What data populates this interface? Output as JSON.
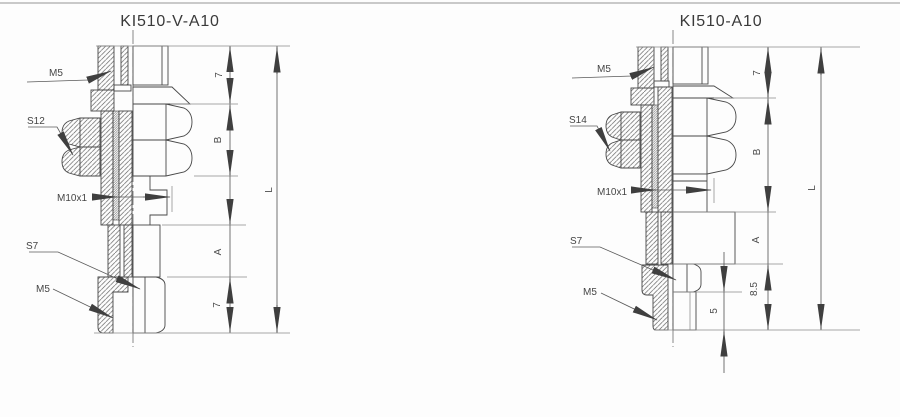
{
  "page": {
    "background": "#fdfdfd",
    "top_rule_color": "#c9c9c9",
    "line_color": "#474747",
    "dimension_color": "#4a4a4a"
  },
  "drawings": [
    {
      "title": "KI510-V-A10",
      "callouts": {
        "thread_top": "M5",
        "hex_size": "S12",
        "thread_mid": "M10x1",
        "hex_small": "S7",
        "thread_bottom": "M5"
      },
      "dimensions": {
        "top_height": "7",
        "upper_section": "B",
        "lower_section": "A",
        "bottom_height": "7",
        "overall_length": "L"
      }
    },
    {
      "title": "KI510-A10",
      "callouts": {
        "thread_top": "M5",
        "hex_size": "S14",
        "thread_mid": "M10x1",
        "hex_small": "S7",
        "thread_bottom": "M5"
      },
      "dimensions": {
        "top_height": "7",
        "upper_section": "B",
        "lower_section": "A",
        "bottom_height": "8.5",
        "stud_length": "5",
        "overall_length": "L"
      }
    }
  ]
}
